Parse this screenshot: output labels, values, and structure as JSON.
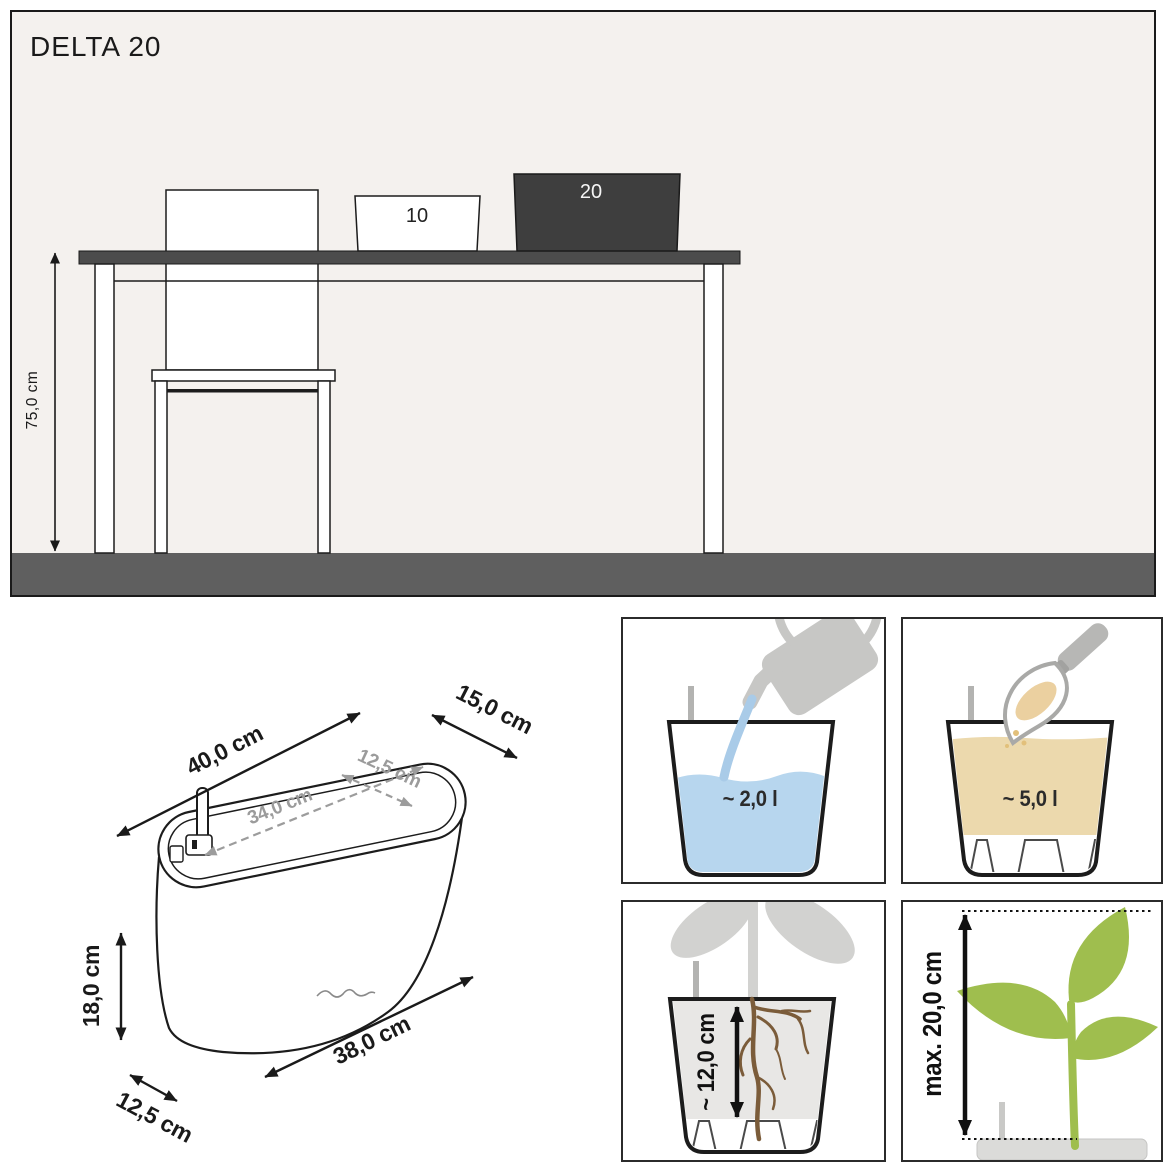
{
  "title": "DELTA 20",
  "scene": {
    "height_label": "75,0 cm",
    "small_planter_label": "10",
    "large_planter_label": "20"
  },
  "dimensions": {
    "outer_length": "40,0 cm",
    "outer_width": "15,0 cm",
    "inner_length": "34,0 cm",
    "inner_width": "12,5 cm",
    "height": "18,0 cm",
    "base_length": "38,0 cm",
    "base_width": "12,5 cm"
  },
  "panels": {
    "water": {
      "label": "~ 2,0 l"
    },
    "substrate": {
      "label": "~ 5,0 l"
    },
    "root_depth": {
      "label": "~ 12,0 cm"
    },
    "plant_height": {
      "label": "max. 20,0 cm"
    }
  },
  "colors": {
    "scene_background": "#f4f1ee",
    "floor_gray": "#5f5f5f",
    "tabletop_gray": "#4c4c4c",
    "planter_dark": "#3e3e3e",
    "outline_black": "#1c1c1c",
    "dim_gray": "#9b9b9b",
    "water_blue": "#b7d6ee",
    "substrate_tan": "#ecd9ad",
    "soil_gray": "#e8e7e5",
    "root_brown": "#7b5c3a",
    "plant_green": "#9fbe4e",
    "silhouette_gray": "#c9c9c7"
  }
}
